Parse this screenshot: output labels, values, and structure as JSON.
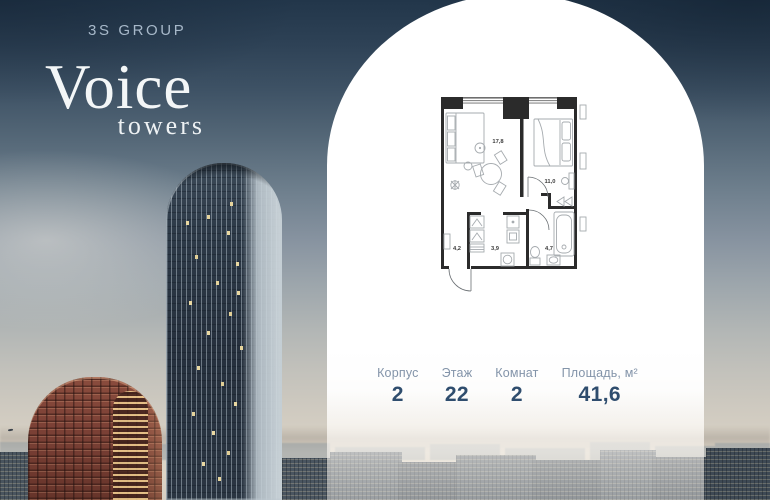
{
  "brand": {
    "group_name": "3S GROUP",
    "project_name": "Voice",
    "project_subname": "towers"
  },
  "floorplan": {
    "rooms": [
      {
        "name": "living-room",
        "area": "17,8"
      },
      {
        "name": "bedroom",
        "area": "11,0"
      },
      {
        "name": "hallway",
        "area": "4,2"
      },
      {
        "name": "storage-room",
        "area": "3,9"
      },
      {
        "name": "bathroom",
        "area": "4,7"
      }
    ]
  },
  "stats": {
    "items": [
      {
        "label": "Корпус",
        "value": "2"
      },
      {
        "label": "Этаж",
        "value": "22"
      },
      {
        "label": "Комнат",
        "value": "2"
      },
      {
        "label": "Площадь, м²",
        "value": "41,6"
      }
    ]
  },
  "colors": {
    "accent_navy": "#2f4d6e",
    "label_blue": "#8394a9",
    "brand_text": "#a7b8c9",
    "panel_white": "#ffffff",
    "sky_top": "#22364a",
    "horizon_warm": "#d8d1c4",
    "tower_red": "#7c4136",
    "tower_blue_glass": "#2b3644"
  }
}
